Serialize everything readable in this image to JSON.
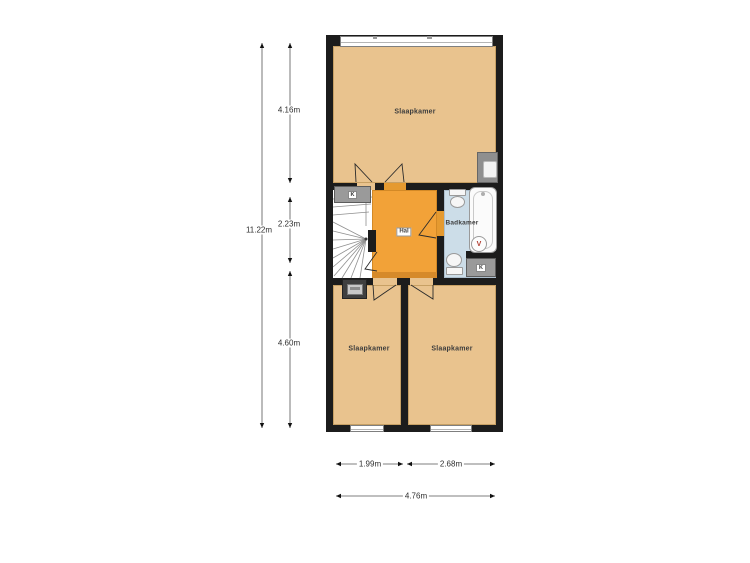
{
  "rooms": {
    "top": {
      "label": "Slaapkamer"
    },
    "hal": {
      "label": "Hal"
    },
    "bath": {
      "label": "Badkamer"
    },
    "bottom_left": {
      "label": "Slaapkamer"
    },
    "bottom_right": {
      "label": "Slaapkamer"
    }
  },
  "closets": {
    "hall": {
      "label": "K"
    },
    "bath": {
      "label": "K"
    }
  },
  "fixtures": {
    "vent": {
      "label": "V"
    },
    "icons": [
      "stairs-icon",
      "toilet-icon",
      "bathtub-icon",
      "sink-icon",
      "meter-cabinet-icon",
      "ventilation-icon"
    ]
  },
  "dims": {
    "v_total": "11.22m",
    "v1": "4.16m",
    "v2": "2.23m",
    "v3": "4.60m",
    "h1": "1.99m",
    "h2": "2.68m",
    "h_total": "4.76m"
  },
  "colors": {
    "wall": "#1c1c1c",
    "bedroom_floor": "#e9c38e",
    "hall_floor": "#f2a238",
    "bath_floor": "#ccdde8",
    "threshold": "#d68a2a",
    "fixture_gray": "#9a9a9a",
    "vent_letter": "#b03a2e",
    "dimension_line": "#555555"
  }
}
